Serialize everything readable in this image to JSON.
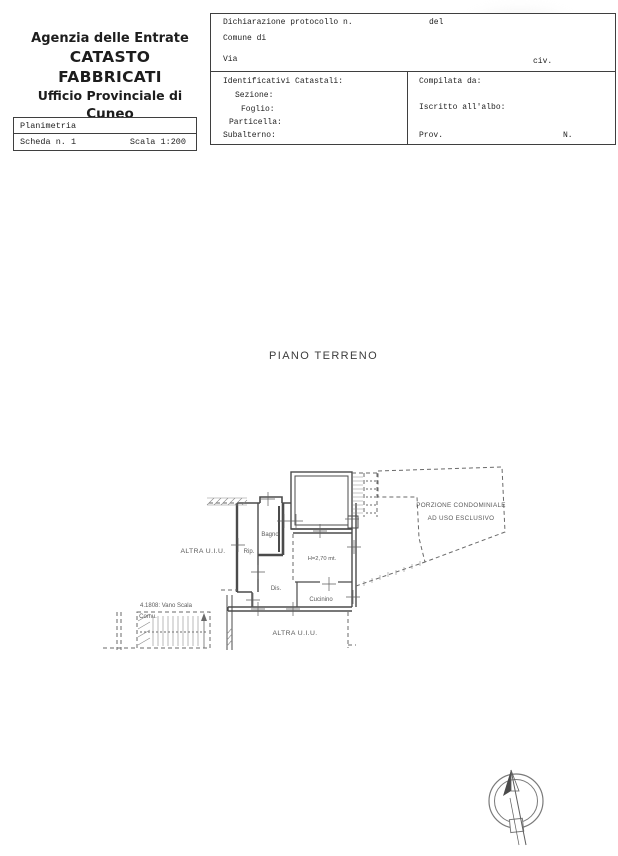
{
  "colors": {
    "ink": "#222222",
    "line": "#3f3f3f",
    "plan_line": "#4b4b4b",
    "dash": "#6a6a6a"
  },
  "header": {
    "agency_line1": "Agenzia delle Entrate",
    "agency_line2": "CATASTO FABBRICATI",
    "agency_line3": "Ufficio Provinciale di",
    "agency_line4": "Cuneo"
  },
  "planimetria_box": {
    "title": "Planimetria",
    "scheda": "Scheda n. 1",
    "scala": "Scala 1:200"
  },
  "form": {
    "protocollo_label": "Dichiarazione protocollo n.",
    "del_label": "del",
    "comune_label": "Comune di",
    "via_label": "Via",
    "civ_label": "civ.",
    "identificativi_label": "Identificativi Catastali:",
    "sezione_label": "Sezione:",
    "foglio_label": "Foglio:",
    "particella_label": "Particella:",
    "subalterno_label": "Subalterno:",
    "compilata_label": "Compilata da:",
    "albo_label": "Iscritto all'albo:",
    "prov_label": "Prov.",
    "n_label": "N."
  },
  "plan": {
    "title": "PIANO TERRENO",
    "labels": {
      "altra_uiu_left": "ALTRA U.I.U.",
      "altra_uiu_bottom": "ALTRA U.I.U.",
      "bagno": "Bagno",
      "rip": "Rip.",
      "dis": "Dis.",
      "cucinino": "Cucinino",
      "altezza": "H=2,70 mt.",
      "porzione_1": "PORZIONE CONDOMINIALE",
      "porzione_2": "AD USO ESCLUSIVO",
      "vano_scala": "4.1808: Vano Scala",
      "comune_abbr": "Comu."
    }
  }
}
